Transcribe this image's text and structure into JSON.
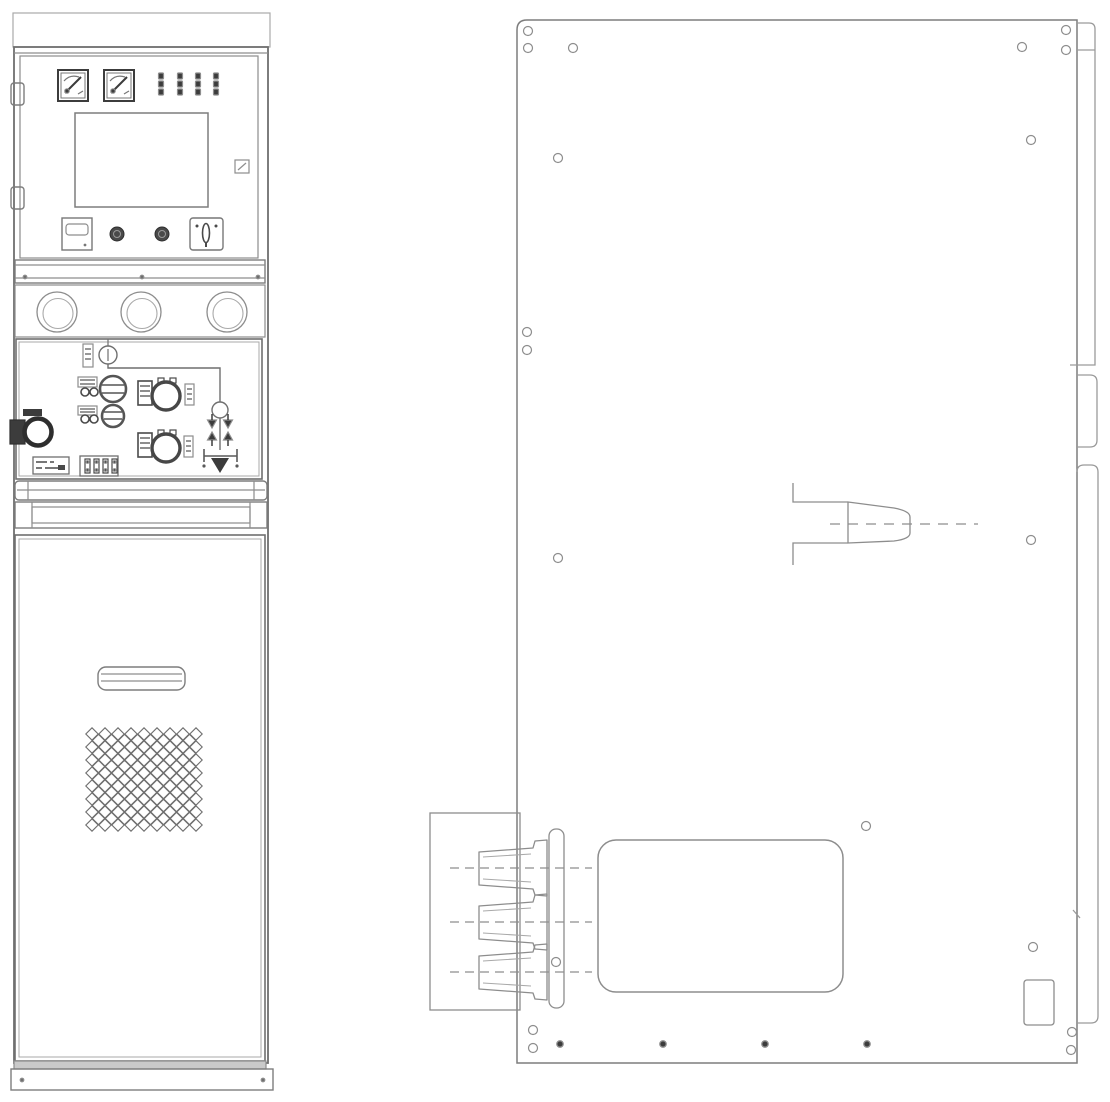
{
  "figure": {
    "type": "technical-line-drawing",
    "views": [
      "front-elevation",
      "side-elevation"
    ],
    "background": "#ffffff",
    "colors": {
      "line": "#8d8d8d",
      "line_light": "#a9a9a9",
      "line_bold": "#5a5a5a",
      "dark": "#3c3c3c",
      "mesh": "#6e6e6e"
    }
  },
  "front_view": {
    "gauges": [
      {
        "x": 58,
        "y": 70,
        "w": 30,
        "h": 31
      },
      {
        "x": 104,
        "y": 70,
        "w": 30,
        "h": 31
      }
    ],
    "indicator_columns": {
      "cx": [
        161,
        180,
        198,
        216
      ],
      "top": 73,
      "segments": 3,
      "seg_w": 5,
      "seg_h": 6,
      "pitch": 8
    },
    "hinges": [
      {
        "x": 11,
        "y": 83,
        "w": 13,
        "h": 22
      },
      {
        "x": 11,
        "y": 187,
        "w": 13,
        "h": 22
      }
    ],
    "buttons": {
      "cx": [
        117,
        162
      ],
      "cy": 234,
      "r": 7
    },
    "band_dots": {
      "x": [
        25,
        142,
        258
      ],
      "y": 277,
      "r": 1.8
    },
    "windows": {
      "cx": [
        57,
        141,
        227
      ],
      "cy": 312,
      "r_outer": 20,
      "r_inner": 15
    },
    "mimic_arrows": {
      "cols": [
        212,
        228
      ],
      "tip_top_y": 428,
      "tip_bottom_y": 432,
      "half_w": 4.5,
      "len": 8,
      "stem": 6
    },
    "terminal_slots": {
      "x": [
        85,
        94,
        103,
        112
      ],
      "y": 459,
      "w": 5,
      "h": 14
    },
    "mesh": {
      "x0": 92,
      "y0": 734,
      "cols": 9,
      "rows": 8,
      "cell": 13,
      "r": 6.2
    },
    "base_dots": {
      "x": [
        22,
        263
      ],
      "y": 1080,
      "r": 1.8
    }
  },
  "side_view": {
    "holes": {
      "r": 4.5,
      "points": [
        [
          528,
          31
        ],
        [
          528,
          48
        ],
        [
          573,
          48
        ],
        [
          1022,
          47
        ],
        [
          1066,
          30
        ],
        [
          1066,
          50
        ],
        [
          558,
          158
        ],
        [
          1031,
          140
        ],
        [
          527,
          332
        ],
        [
          527,
          350
        ],
        [
          558,
          558
        ],
        [
          1031,
          540
        ],
        [
          866,
          826
        ],
        [
          1033,
          947
        ],
        [
          556,
          962
        ],
        [
          533,
          1030
        ],
        [
          533,
          1048
        ],
        [
          1072,
          1032
        ],
        [
          1071,
          1050
        ]
      ]
    },
    "bottom_dots": {
      "r": 3.2,
      "points": [
        [
          560,
          1044
        ],
        [
          663,
          1044
        ],
        [
          765,
          1044
        ],
        [
          867,
          1044
        ]
      ]
    },
    "cable_bushings": {
      "cy": [
        868,
        922,
        972
      ],
      "tip_x": 479,
      "base_x": 534,
      "bell_x": 547,
      "dash_x1": 450,
      "dash_x2": 592
    },
    "side_bushing": {
      "centerline_y": 524,
      "dash_x1": 830,
      "dash_x2": 978
    }
  }
}
